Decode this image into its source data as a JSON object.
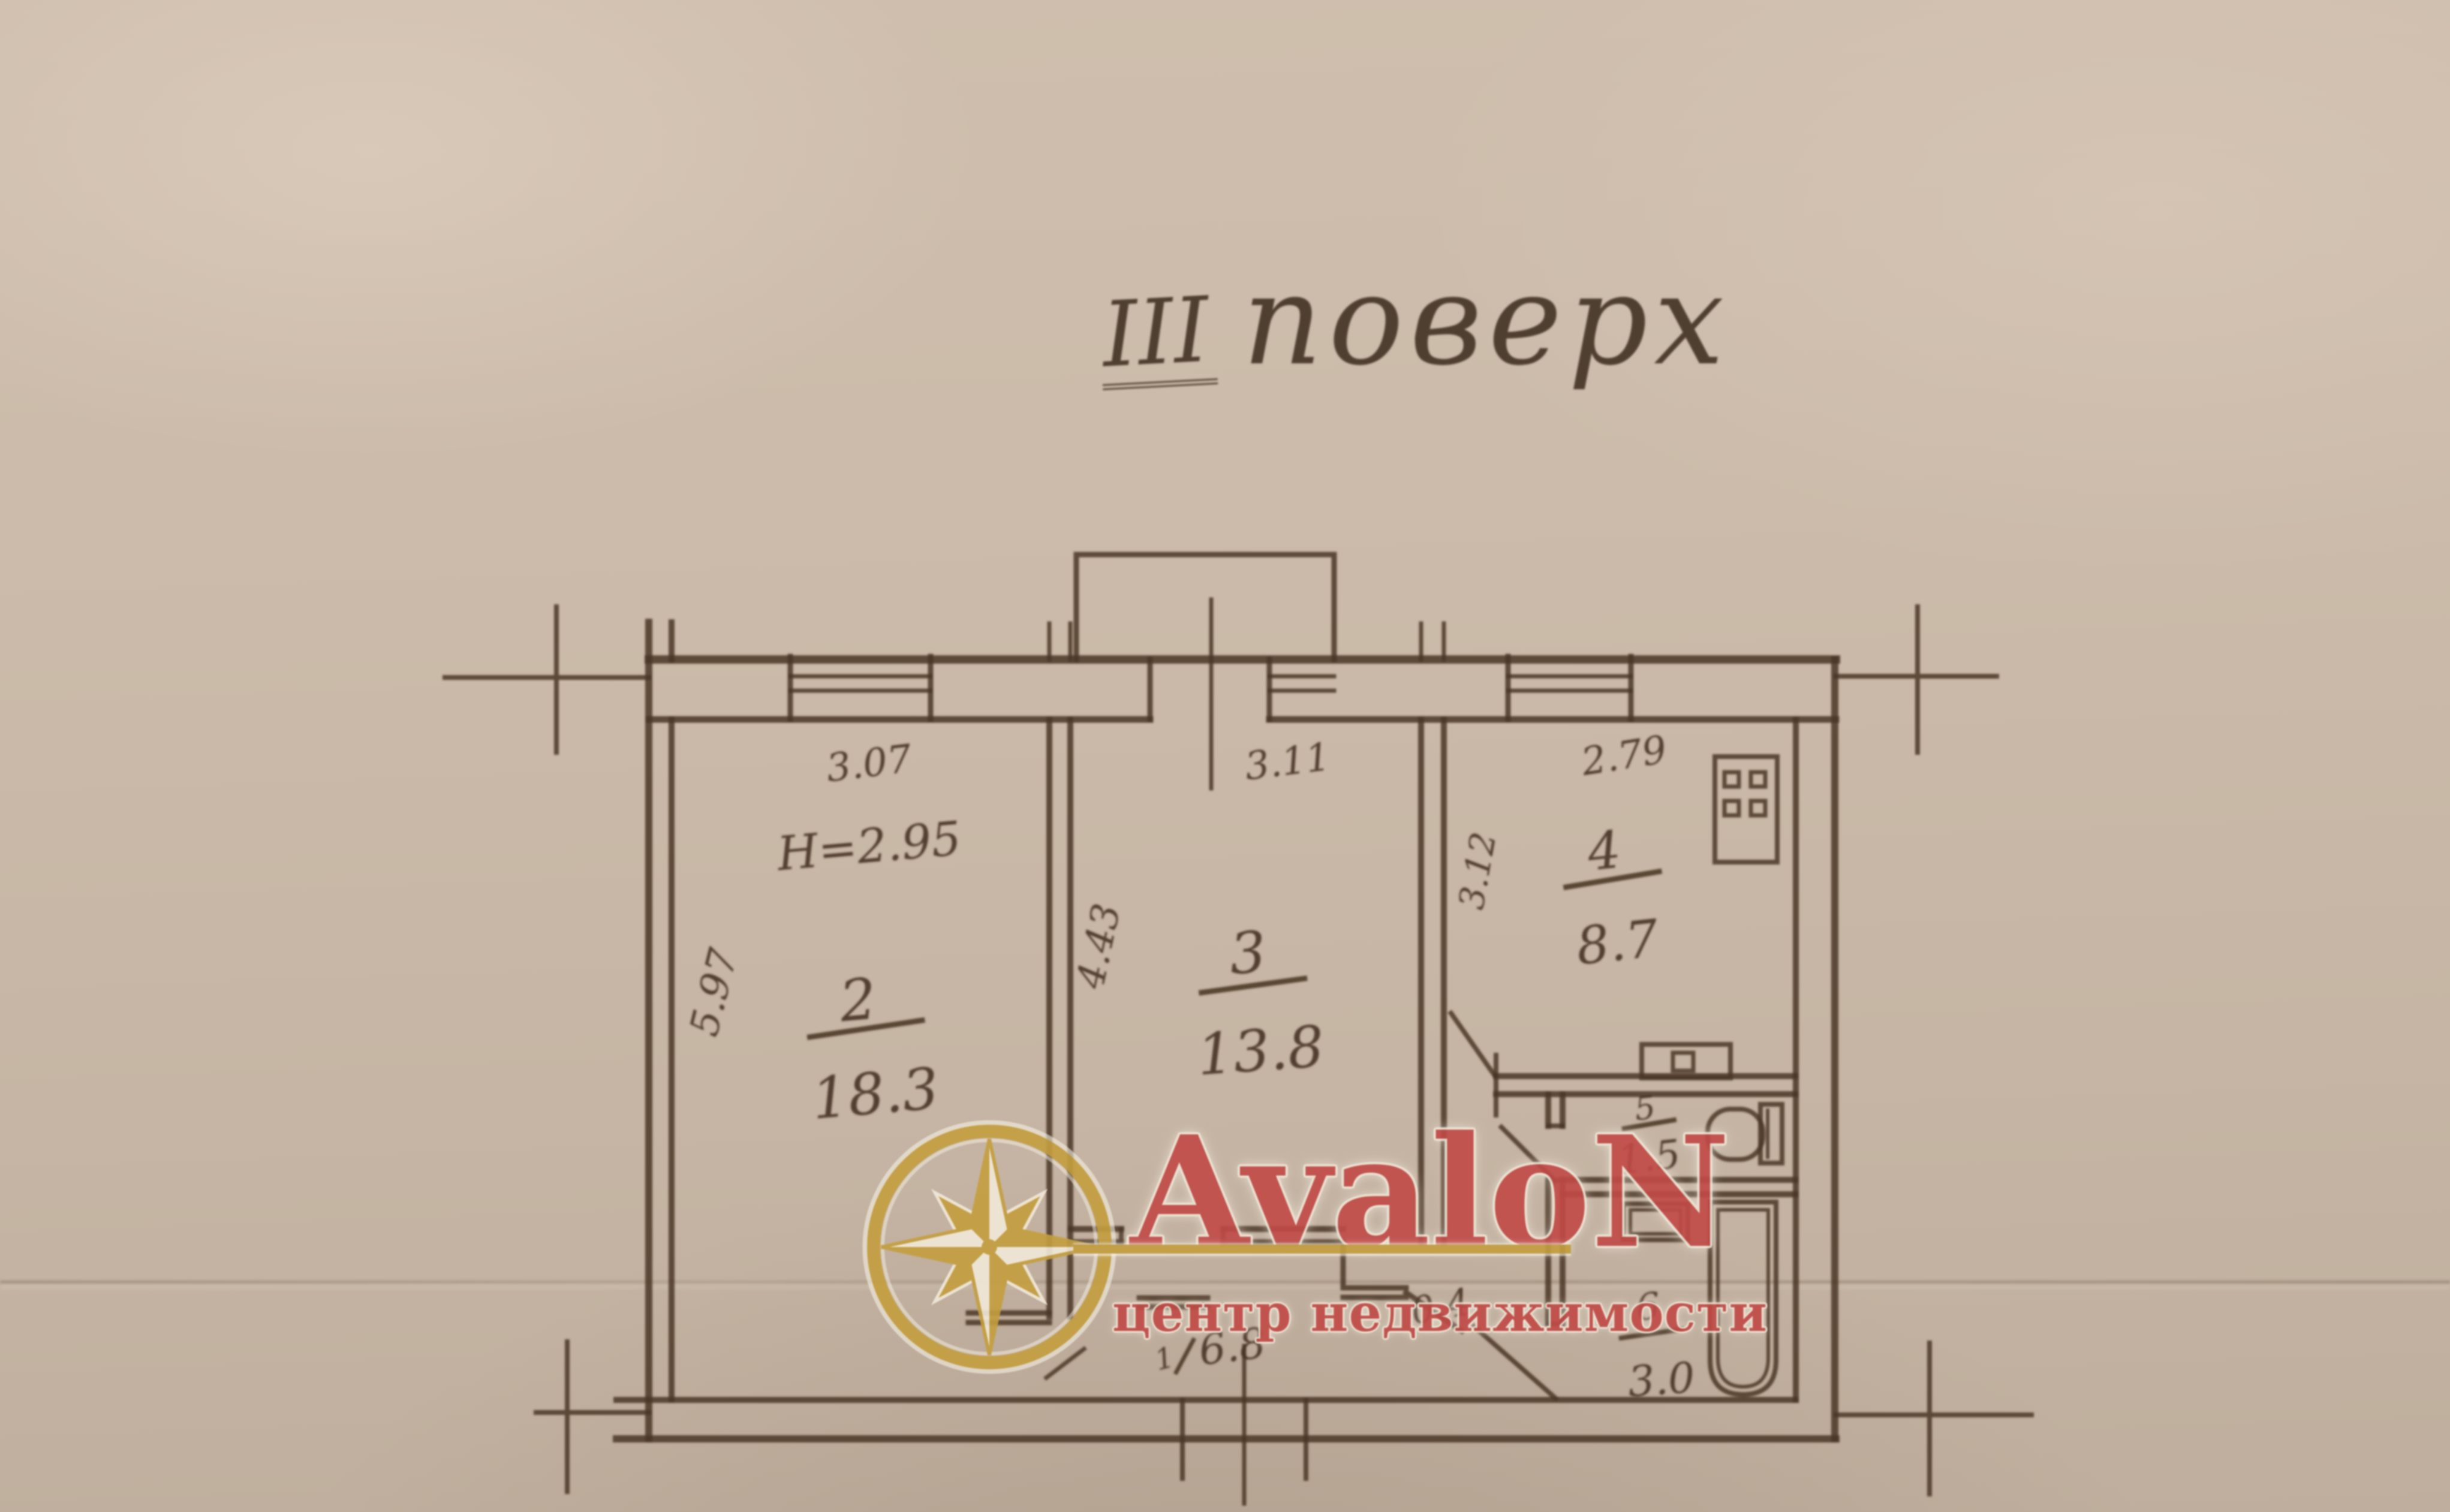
{
  "title": {
    "roman": "III",
    "word": "поверх"
  },
  "rooms": [
    {
      "key": "living-room",
      "number": "2",
      "area": "18.3"
    },
    {
      "key": "bedroom",
      "number": "3",
      "area": "13.8"
    },
    {
      "key": "kitchen",
      "number": "4",
      "area": "8.7"
    },
    {
      "key": "wc",
      "number": "5",
      "area": "1.5"
    },
    {
      "key": "bathroom",
      "number": "6",
      "area": "3.0"
    },
    {
      "key": "hallway",
      "number": "1",
      "area": "6.8"
    },
    {
      "key": "niche",
      "number": "",
      "area": "0.4"
    }
  ],
  "dimensions": {
    "room2_width": "3.07",
    "room2_ceiling": "H=2.95",
    "room2_depth": "5.97",
    "room3_width": "3.11",
    "room3_depth": "4.43",
    "kitchen_width": "2.79",
    "kitchen_depth": "3.12"
  },
  "watermark": {
    "brand": "AvaloN",
    "subtitle": "центр недвижимости"
  },
  "colors": {
    "paper": "#c9b7a6",
    "ink": "#4a3627",
    "watermark_red": "#c24a47",
    "watermark_gold": "#c49f3f"
  }
}
